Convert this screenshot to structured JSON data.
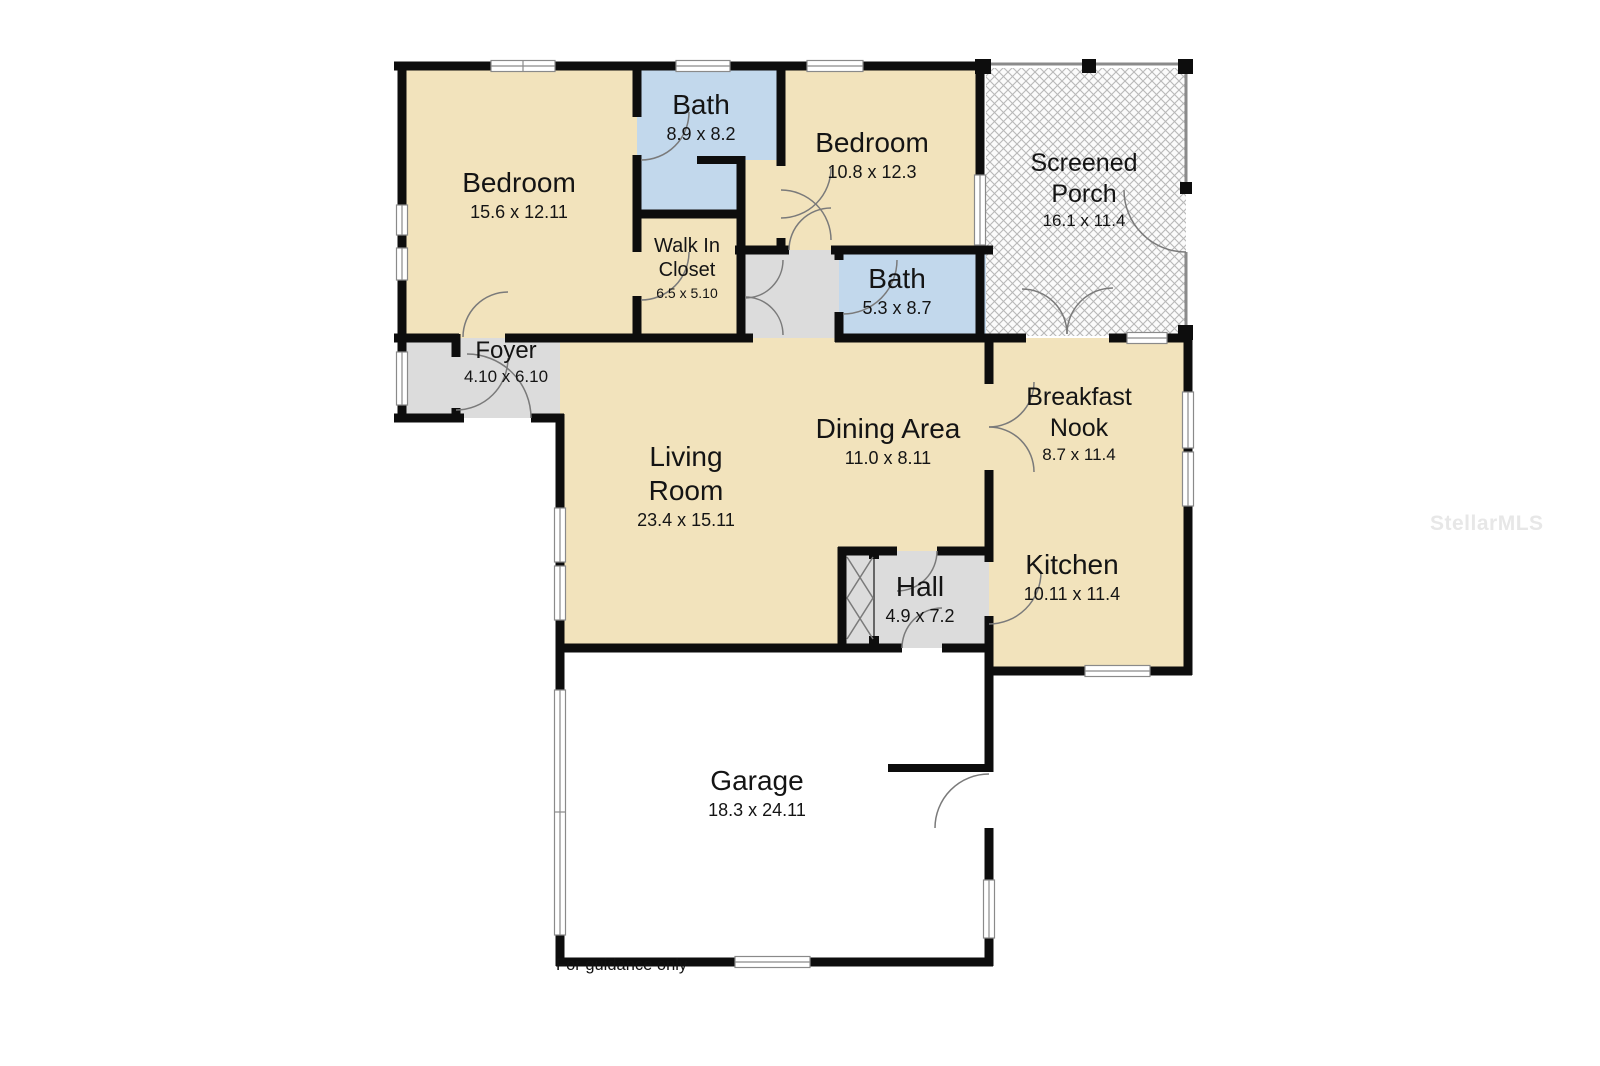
{
  "floorplan": {
    "disclaimer": "For guidance only",
    "watermark": "StellarMLS",
    "colors": {
      "room_tan": "#f2e3bc",
      "room_blue": "#c2d8ec",
      "room_gray": "#dcdcdc",
      "wall": "#0d0d0d",
      "door_arc": "#7a7a7a",
      "porch_hatch": "#b8b8b8"
    },
    "rooms": [
      {
        "id": "bedroom-1",
        "name": "Bedroom",
        "dims": "15.6 x 12.11"
      },
      {
        "id": "bath-1",
        "name": "Bath",
        "dims": "8.9 x 8.2"
      },
      {
        "id": "bedroom-2",
        "name": "Bedroom",
        "dims": "10.8 x 12.3"
      },
      {
        "id": "screened-porch",
        "name": "Screened\nPorch",
        "dims": "16.1 x 11.4"
      },
      {
        "id": "walk-in-closet",
        "name": "Walk In\nCloset",
        "dims": "6.5 x 5.10"
      },
      {
        "id": "bath-2",
        "name": "Bath",
        "dims": "5.3 x 8.7"
      },
      {
        "id": "foyer",
        "name": "Foyer",
        "dims": "4.10 x 6.10"
      },
      {
        "id": "living-room",
        "name": "Living\nRoom",
        "dims": "23.4 x 15.11"
      },
      {
        "id": "dining-area",
        "name": "Dining Area",
        "dims": "11.0 x 8.11"
      },
      {
        "id": "breakfast-nook",
        "name": "Breakfast\nNook",
        "dims": "8.7 x 11.4"
      },
      {
        "id": "kitchen",
        "name": "Kitchen",
        "dims": "10.11 x 11.4"
      },
      {
        "id": "hall",
        "name": "Hall",
        "dims": "4.9 x 7.2"
      },
      {
        "id": "garage",
        "name": "Garage",
        "dims": "18.3 x 24.11"
      }
    ]
  }
}
